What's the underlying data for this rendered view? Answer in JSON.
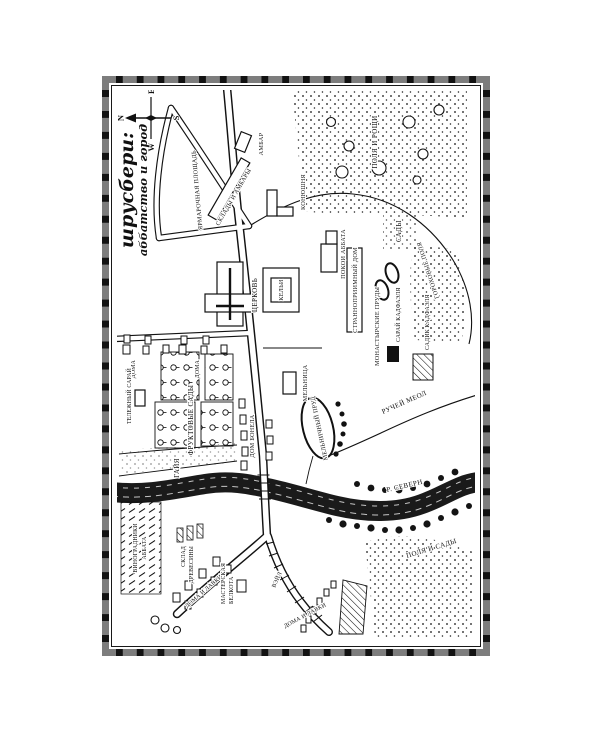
{
  "map": {
    "title": {
      "line1": "шрусбери:",
      "line2": "аббатство и город"
    },
    "compass": {
      "n": "N",
      "s": "S",
      "w": "W",
      "e": "E"
    },
    "ink": "#111111",
    "paper": "#ffffff",
    "labels": {
      "fair_square": "ЯРМАРОЧНАЯ ПЛОЩАДЬ",
      "barn": "АМБАР",
      "warehouses": "СКЛАДЫ И АМБАРЫ",
      "stable": "КОНЮШНЯ",
      "houses_a": "ДОМА",
      "houses_b": "ДОМА",
      "church": "ЦЕРКОВЬ",
      "cells": "КЕЛЬИ",
      "abbot": "ПОКОИ АББАТА",
      "guest": "СТРАННОПРИИМНЫЙ ДОМ",
      "ponds": "МОНАСТЫРСКИЕ ПРУДЫ",
      "gardens": "САДЫ",
      "shed": "САРАЙ КАДФАЭЛЯ",
      "herb_garden": "САДИК КАДФАЭЛЯ",
      "pea_fields": "ГОРОХОВЫЕ ПОЛЯ",
      "fields_groves": "ПОЛЯ И РОЩИ",
      "cart_shed": "ТЕЛЕЖНЫЙ САРАЙ",
      "orchards": "ФРУКТОВЫЕ САДЫ",
      "bonel": "ДОМ БОНЕЛА",
      "mill": "МЕЛЬНИЦА",
      "mill_pond": "МЕЛЬНИЧНЫЙ ПРУД",
      "brook": "РУЧЕЙ МЕОЛ",
      "severn": "Р. СЕВЕРН",
      "fields_gardens": "ПОЛЯ И САДЫ",
      "vineyards_l1": "ВИНОГРАДНИКИ",
      "vineyards_l2": "АББАТА",
      "gaye": "ГАЙЯ",
      "timber_l1": "СКЛАД",
      "timber_l2": "ДРЕВЕСИНЫ",
      "shops_a": "ДОМА И ЛАВКИ",
      "shops_b": "ДОМА И ЛАВКИ",
      "workshop_l1": "МАСТЕРСКАЯ",
      "workshop_l2": "БЕЛКОТА",
      "wyle": "ВЭЙЛ"
    }
  }
}
